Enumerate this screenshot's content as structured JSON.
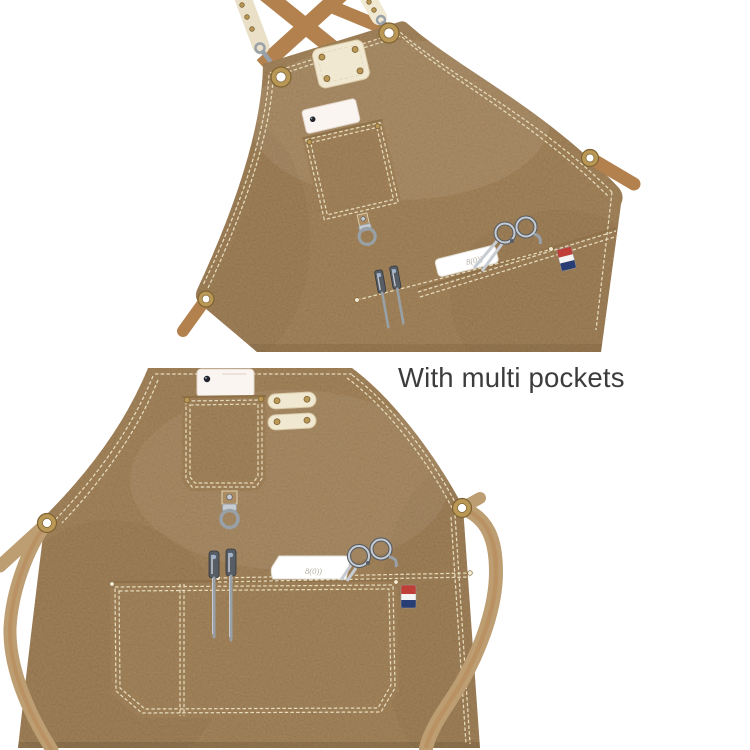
{
  "image": {
    "type": "product-detail-photo",
    "caption": "With multi pockets",
    "product": "khaki canvas work apron with cross-back straps and multiple pockets",
    "comb_logo_text": "8(0))",
    "views": [
      {
        "name": "apron-top-view",
        "description": "upper bib of apron, tilted, showing crossed shoulder straps, cream leather strap ends with snap hooks, brass grommets, riveted leather label patch, phone in chest pocket, D-ring, waist pocket with scissors, comb, sectioning clips and striped flag tag, side strap through grommet"
      },
      {
        "name": "apron-bottom-view",
        "description": "lower half of apron showing chest pocket with phone, two riveted leather tabs, D-ring hanger, tool band with two sectioning clips, comb and scissors, striped flag tag, large divided waist pocket, waist straps threaded through brass grommets hanging down both sides"
      }
    ]
  },
  "palette": {
    "background": "#ffffff",
    "fabric": "#ad8c62",
    "fabricDark": "#8f7149",
    "fabricLight": "#c2a47a",
    "strapTan": "#b3814e",
    "strapKhaki": "#bd9e73",
    "cream": "#f1e8d2",
    "creamShade": "#d9c9a6",
    "stitch": "#e6dcbe",
    "brass": "#b99755",
    "brassDark": "#7e6233",
    "steelLight": "#c7ccd2",
    "steelMid": "#98a0a8",
    "steelDark": "#565d64",
    "phoneWhite": "#fbf5f1",
    "combWhite": "#ffffff",
    "flagRed": "#bf3f38",
    "flagWhite": "#f4f4f4",
    "flagBlue": "#273d73",
    "captionInk": "#3c3c3c"
  }
}
